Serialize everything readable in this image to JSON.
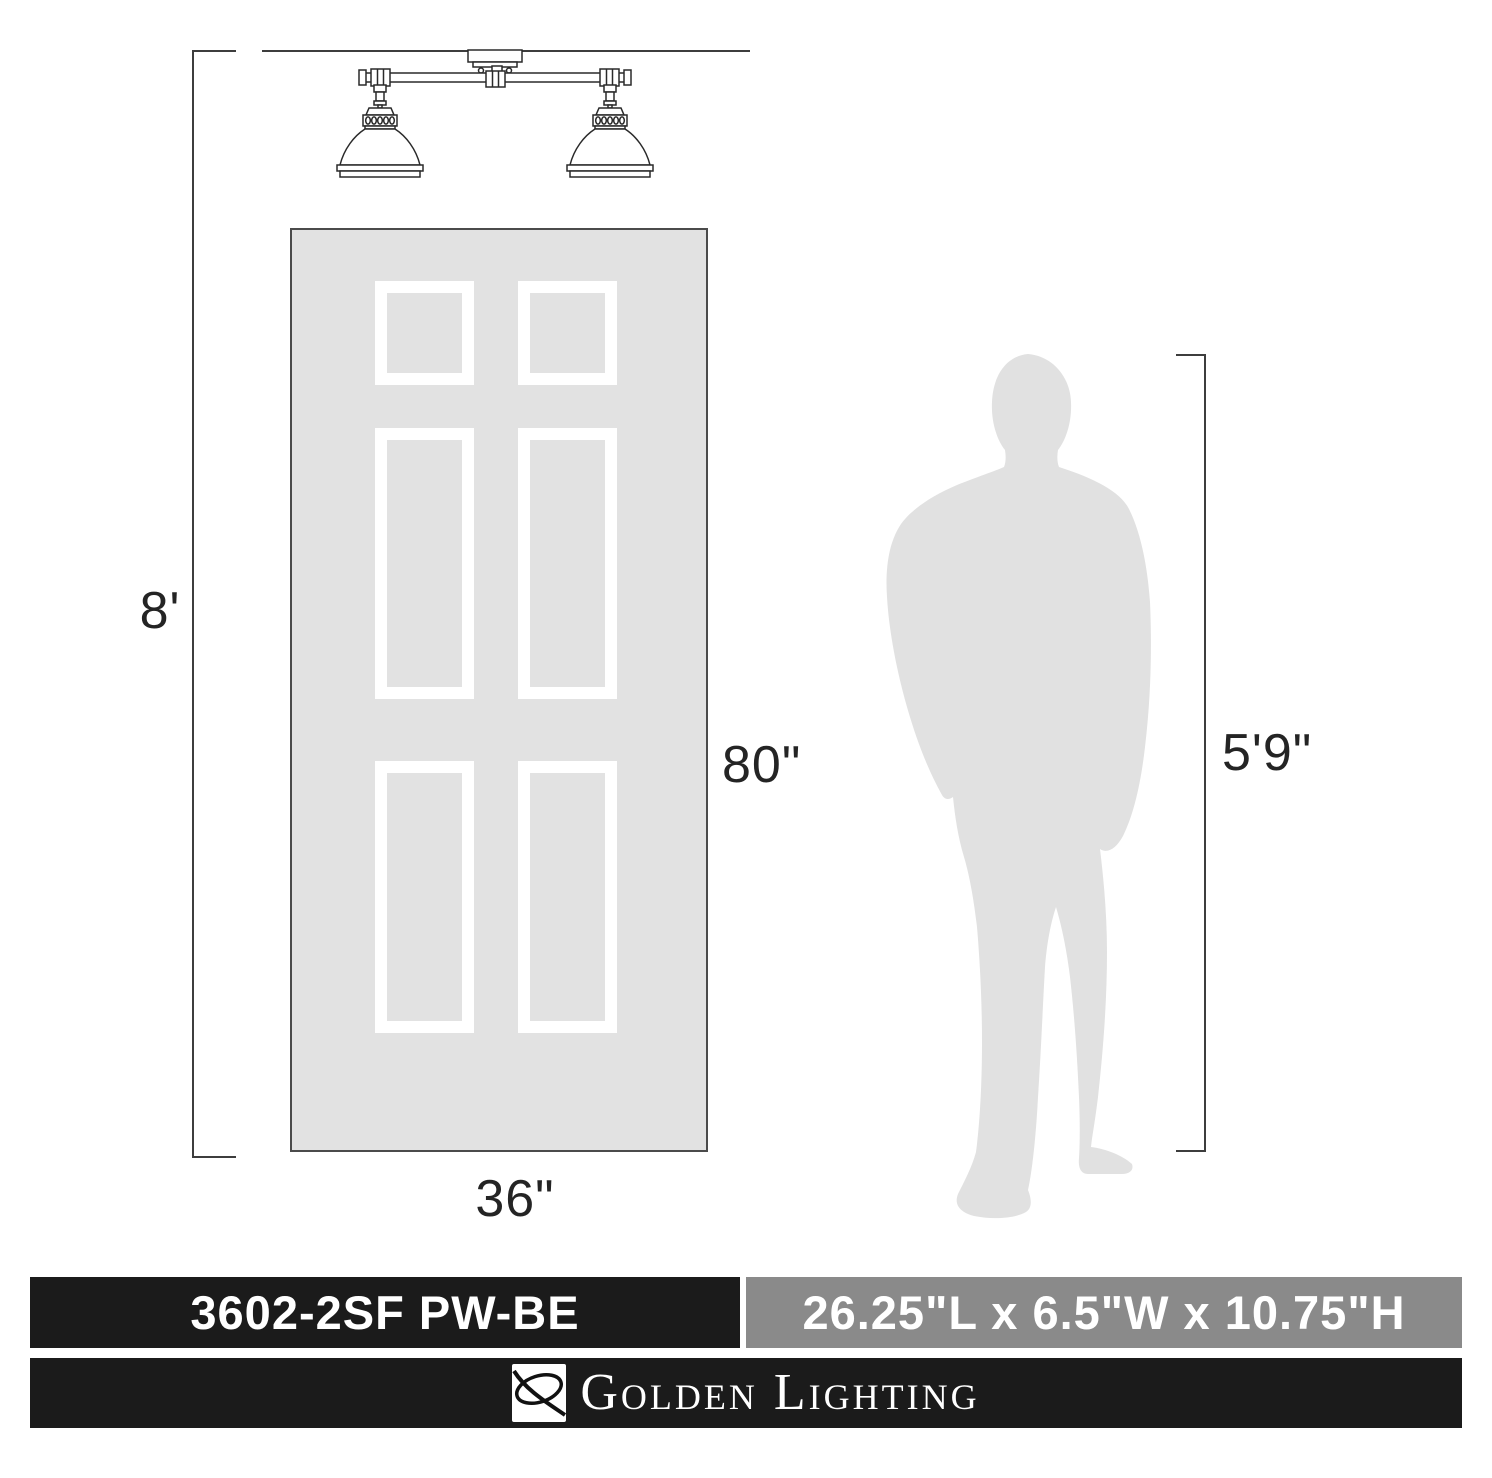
{
  "scale_labels": {
    "ceiling_height": "8'",
    "door_height": "80\"",
    "door_width": "36\"",
    "person_height": "5'9\""
  },
  "footer": {
    "model": "3602-2SF PW-BE",
    "size": "26.25\"L x 6.5\"W x 10.75\"H",
    "brand": "Golden Lighting"
  },
  "graphics": {
    "fixture": "two-light-semi-flush-line-drawing",
    "door": "six-panel-door-silhouette",
    "person": "standing-man-silhouette",
    "brand_logo": "golden-lighting-s-logo"
  },
  "colors": {
    "silhouette_gray": "#e2e2e2",
    "door_border": "#4b4b4b",
    "dimension_line": "#3d3d3d",
    "dimension_text": "#242424",
    "bar_black": "#1b1b1b",
    "bar_gray": "#8a8a8a",
    "bar_text": "#ffffff"
  }
}
